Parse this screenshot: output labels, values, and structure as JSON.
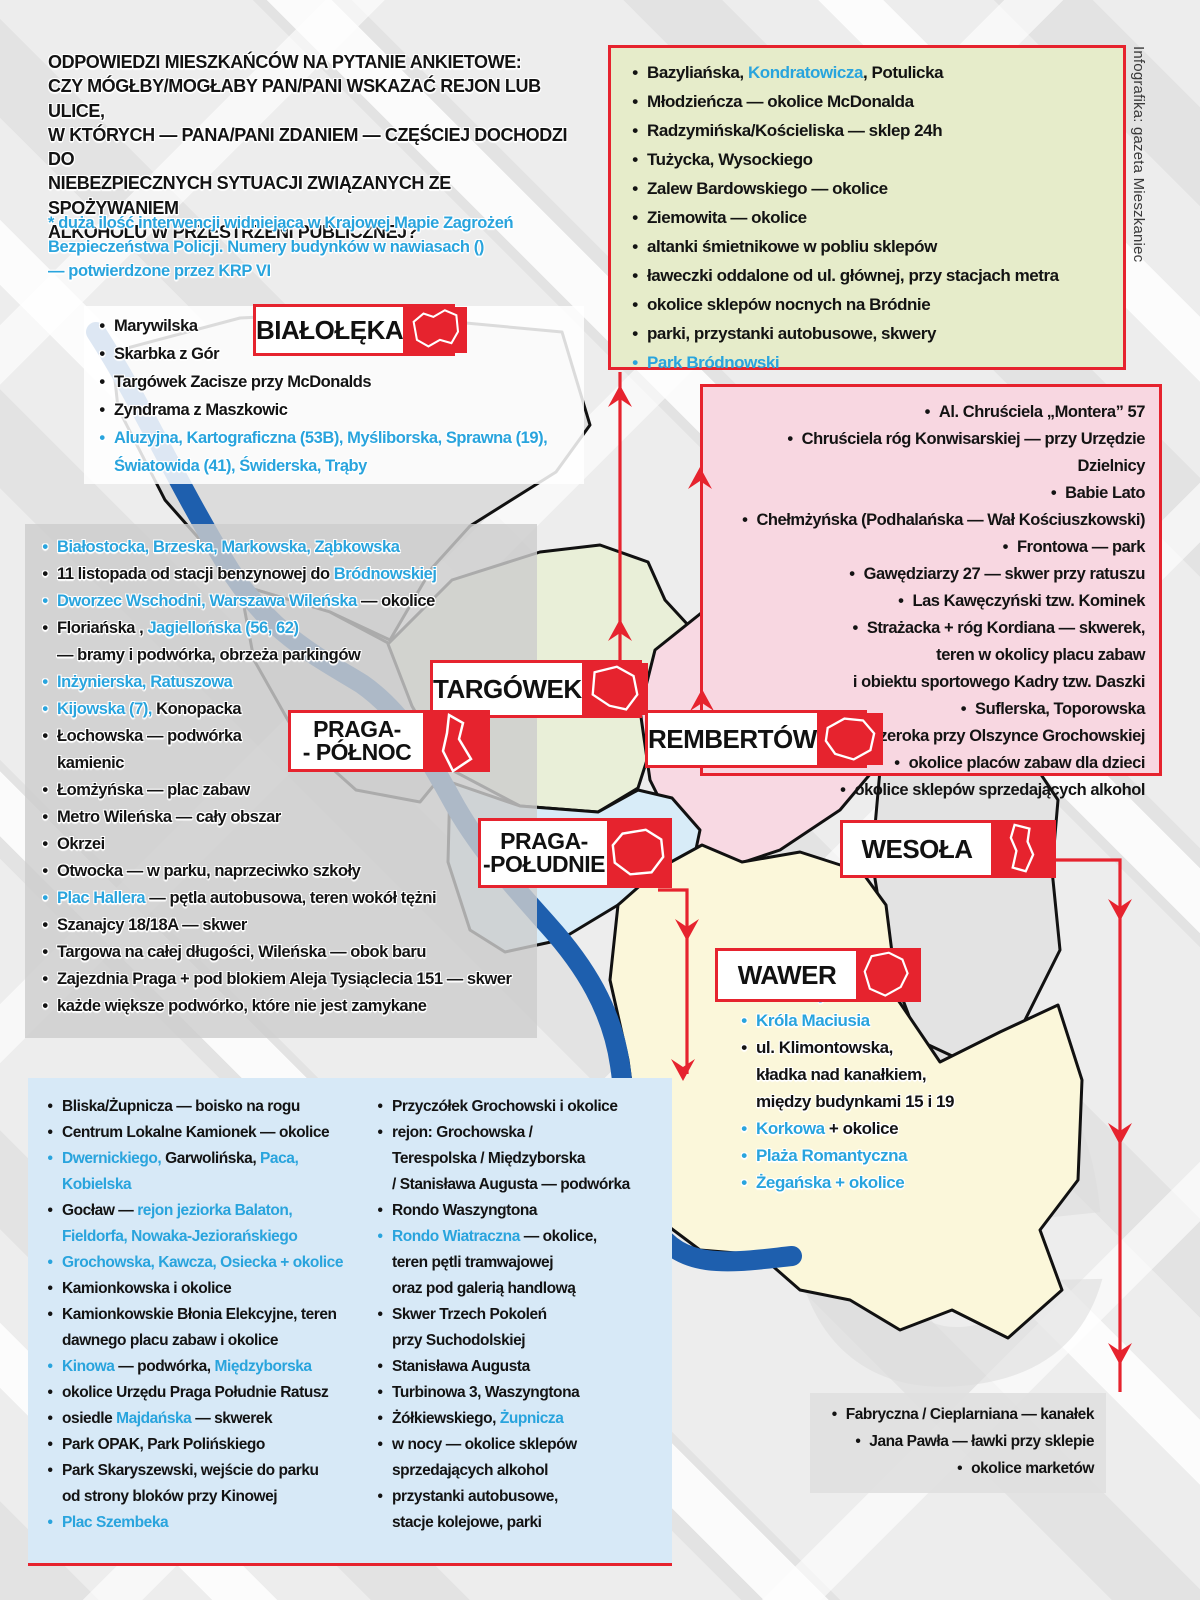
{
  "meta": {
    "credit": "Infografika: gazeta Mieszkaniec"
  },
  "colors": {
    "accent_red": "#e6232e",
    "link_blue": "#29a4dd",
    "river_blue": "#1e5fae",
    "green_box_bg": "#e6ecca",
    "pink_box_bg": "#f8d7e1",
    "blue_box_bg": "#d7e9f7",
    "gray_box_bg": "#cdcdcd",
    "wawer_yellow": "#fbf7d8",
    "district_gray": "#dcdcdc"
  },
  "header": {
    "title": "ODPOWIEDZI MIESZKAŃCÓW NA PYTANIE ANKIETOWE:\nCZY MÓGŁBY/MOGŁABY PAN/PANI WSKAZAĆ REJON LUB ULICE,\nW KTÓRYCH — PANA/PANI ZDANIEM — CZĘŚCIEJ DOCHODZI DO\nNIEBEZPIECZNYCH SYTUACJI ZWIĄZANYCH ZE SPOŻYWANIEM\nALKOHOLU W PRZESTRZENI PUBLICZNEJ?",
    "note": "* duża ilość interwencji widniejąca w Krajowej Mapie Zagrożeń\nBezpieczeństwa Policji. Numery budynków w nawiasach ()\n— potwierdzone przez KRP VI"
  },
  "districts": [
    {
      "id": "bialoleka",
      "label": "BIAŁOŁĘKA"
    },
    {
      "id": "targowek",
      "label": "TARGÓWEK"
    },
    {
      "id": "praga-polnoc",
      "label": "PRAGA-\n- PÓŁNOC"
    },
    {
      "id": "rembertow",
      "label": "REMBERTÓW"
    },
    {
      "id": "praga-poludnie",
      "label": "PRAGA-\n-POŁUDNIE"
    },
    {
      "id": "wesola",
      "label": "WESOŁA"
    },
    {
      "id": "wawer",
      "label": "WAWER"
    }
  ],
  "lists": {
    "bialoleka": {
      "items": [
        [
          {
            "t": "Marywilska",
            "c": "k"
          }
        ],
        [
          {
            "t": "Skarbka z Gór",
            "c": "k"
          }
        ],
        [
          {
            "t": "Targówek Zacisze przy McDonalds",
            "c": "k"
          }
        ],
        [
          {
            "t": "Zyndrama z Maszkowic",
            "c": "k"
          }
        ],
        [
          {
            "t": "Aluzyjna, Kartograficzna (53B), Myśliborska, Sprawna (19),\nŚwiatowida (41), Świderska, Trąby",
            "c": "b"
          }
        ]
      ]
    },
    "targowek": {
      "items": [
        [
          {
            "t": "Bazyliańska, ",
            "c": "k"
          },
          {
            "t": "Kondratowicza",
            "c": "b"
          },
          {
            "t": ", Potulicka",
            "c": "k"
          }
        ],
        [
          {
            "t": "Młodzieńcza — okolice McDonalda",
            "c": "k"
          }
        ],
        [
          {
            "t": "Radzymińska/Kościeliska — sklep 24h",
            "c": "k"
          }
        ],
        [
          {
            "t": "Tużycka, Wysockiego",
            "c": "k"
          }
        ],
        [
          {
            "t": "Zalew Bardowskiego — okolice",
            "c": "k"
          }
        ],
        [
          {
            "t": "Ziemowita — okolice",
            "c": "k"
          }
        ],
        [
          {
            "t": "altanki śmietnikowe w pobliu sklepów",
            "c": "k"
          }
        ],
        [
          {
            "t": "ławeczki oddalone od ul. głównej, przy stacjach metra",
            "c": "k"
          }
        ],
        [
          {
            "t": "okolice sklepów nocnych na Bródnie",
            "c": "k"
          }
        ],
        [
          {
            "t": "parki, przystanki autobusowe, skwery",
            "c": "k"
          }
        ],
        [
          {
            "t": "Park Bródnowski",
            "c": "b"
          }
        ]
      ]
    },
    "rembertow": {
      "items": [
        [
          {
            "t": "Al. Chruściela „Montera” 57",
            "c": "k"
          }
        ],
        [
          {
            "t": "Chruściela róg Konwisarskiej — przy Urzędzie Dzielnicy",
            "c": "k"
          }
        ],
        [
          {
            "t": "Babie Lato",
            "c": "k"
          }
        ],
        [
          {
            "t": "Chełmżyńska (Podhalańska — Wał Kościuszkowski)",
            "c": "k"
          }
        ],
        [
          {
            "t": "Frontowa — park",
            "c": "k"
          }
        ],
        [
          {
            "t": "Gawędziarzy 27 — skwer przy ratuszu",
            "c": "k"
          }
        ],
        [
          {
            "t": "Las Kawęczyński tzw. Kominek",
            "c": "k"
          }
        ],
        [
          {
            "t": "Strażacka + róg Kordiana — skwerek,\nteren w okolicy placu zabaw\ni obiektu sportowego Kadry tzw. Daszki",
            "c": "k"
          }
        ],
        [
          {
            "t": "Suflerska, Toporowska",
            "c": "k"
          }
        ],
        [
          {
            "t": "Szeroka przy Olszynce Grochowskiej",
            "c": "k"
          }
        ],
        [
          {
            "t": "okolice placów zabaw dla dzieci",
            "c": "k"
          }
        ],
        [
          {
            "t": "okolice sklepów sprzedających alkohol",
            "c": "k"
          }
        ]
      ]
    },
    "praga_polnoc": {
      "items": [
        [
          {
            "t": "Białostocka, Brzeska, Markowska, Ząbkowska",
            "c": "b"
          }
        ],
        [
          {
            "t": "11 listopada od stacji benzynowej do ",
            "c": "k"
          },
          {
            "t": "Bródnowskiej",
            "c": "b"
          }
        ],
        [
          {
            "t": "Dworzec Wschodni, Warszawa Wileńska",
            "c": "b"
          },
          {
            "t": " — okolice",
            "c": "k"
          }
        ],
        [
          {
            "t": "Floriańska , ",
            "c": "k"
          },
          {
            "t": "Jagiellońska (56, 62)",
            "c": "b"
          },
          {
            "t": "\n— bramy i podwórka, obrzeża parkingów",
            "c": "k"
          }
        ],
        [
          {
            "t": "Inżynierska, Ratuszowa",
            "c": "b"
          }
        ],
        [
          {
            "t": "Kijowska (7), ",
            "c": "b"
          },
          {
            "t": "Konopacka",
            "c": "k"
          }
        ],
        [
          {
            "t": "Łochowska — podwórka\nkamienic",
            "c": "k"
          }
        ],
        [
          {
            "t": "Łomżyńska — plac zabaw",
            "c": "k"
          }
        ],
        [
          {
            "t": "Metro Wileńska — cały obszar",
            "c": "k"
          }
        ],
        [
          {
            "t": "Okrzei",
            "c": "k"
          }
        ],
        [
          {
            "t": "Otwocka — w parku, naprzeciwko szkoły",
            "c": "k"
          }
        ],
        [
          {
            "t": "Plac Hallera",
            "c": "b"
          },
          {
            "t": " — pętla autobusowa, teren wokół tężni",
            "c": "k"
          }
        ],
        [
          {
            "t": "Szanajcy 18/18A — skwer",
            "c": "k"
          }
        ],
        [
          {
            "t": "Targowa na całej długości, Wileńska — obok baru",
            "c": "k"
          }
        ],
        [
          {
            "t": "Zajezdnia Praga + pod blokiem Aleja Tysiąclecia 151 — skwer",
            "c": "k"
          }
        ],
        [
          {
            "t": "każde większe podwórko, które nie jest zamykane",
            "c": "k"
          }
        ]
      ]
    },
    "praga_poludnie_col1": {
      "items": [
        [
          {
            "t": "Bliska/Żupnicza — boisko na rogu",
            "c": "k"
          }
        ],
        [
          {
            "t": "Centrum Lokalne Kamionek — okolice",
            "c": "k"
          }
        ],
        [
          {
            "t": "Dwernickiego, ",
            "c": "b"
          },
          {
            "t": "Garwolińska, ",
            "c": "k"
          },
          {
            "t": "Paca,\nKobielska",
            "c": "b"
          }
        ],
        [
          {
            "t": "Gocław — ",
            "c": "k"
          },
          {
            "t": "rejon jeziorka Balaton,\nFieldorfa, Nowaka-Jeziorańskiego",
            "c": "b"
          }
        ],
        [
          {
            "t": "Grochowska, Kawcza, Osiecka + okolice",
            "c": "b"
          }
        ],
        [
          {
            "t": "Kamionkowska i okolice",
            "c": "k"
          }
        ],
        [
          {
            "t": "Kamionkowskie Błonia Elekcyjne, teren\ndawnego placu zabaw i okolice",
            "c": "k"
          }
        ],
        [
          {
            "t": "Kinowa",
            "c": "b"
          },
          {
            "t": " — podwórka, ",
            "c": "k"
          },
          {
            "t": "Międzyborska",
            "c": "b"
          }
        ],
        [
          {
            "t": "okolice Urzędu Praga Południe Ratusz",
            "c": "k"
          }
        ],
        [
          {
            "t": "osiedle ",
            "c": "k"
          },
          {
            "t": "Majdańska",
            "c": "b"
          },
          {
            "t": " — skwerek",
            "c": "k"
          }
        ],
        [
          {
            "t": "Park OPAK, Park Polińskiego",
            "c": "k"
          }
        ],
        [
          {
            "t": "Park Skaryszewski, wejście do parku\nod strony bloków przy Kinowej",
            "c": "k"
          }
        ],
        [
          {
            "t": "Plac Szembeka",
            "c": "b"
          }
        ]
      ]
    },
    "praga_poludnie_col2": {
      "items": [
        [
          {
            "t": "Przyczółek Grochowski i okolice",
            "c": "k"
          }
        ],
        [
          {
            "t": "rejon: Grochowska /\nTerespolska / Międzyborska\n/ Stanisława Augusta — podwórka",
            "c": "k"
          }
        ],
        [
          {
            "t": "Rondo Waszyngtona",
            "c": "k"
          }
        ],
        [
          {
            "t": "Rondo Wiatraczna",
            "c": "b"
          },
          {
            "t": " — okolice,\nteren pętli tramwajowej\noraz pod galerią handlową",
            "c": "k"
          }
        ],
        [
          {
            "t": "Skwer Trzech Pokoleń\nprzy Suchodolskiej",
            "c": "k"
          }
        ],
        [
          {
            "t": "Stanisława Augusta",
            "c": "k"
          }
        ],
        [
          {
            "t": "Turbinowa 3, Waszyngtona",
            "c": "k"
          }
        ],
        [
          {
            "t": "Żółkiewskiego, ",
            "c": "k"
          },
          {
            "t": "Żupnicza",
            "c": "b"
          }
        ],
        [
          {
            "t": "w nocy — okolice sklepów\nsprzedających alkohol",
            "c": "k"
          }
        ],
        [
          {
            "t": "przystanki autobusowe,\nstacje kolejowe, parki",
            "c": "k"
          }
        ]
      ]
    },
    "wawer": {
      "items": [
        [
          {
            "t": "Derkaczy + okolice",
            "c": "b"
          }
        ],
        [
          {
            "t": "Króla Maciusia",
            "c": "b"
          }
        ],
        [
          {
            "t": "ul. Klimontowska,\nkładka nad kanałkiem,\nmiędzy budynkami 15 i 19",
            "c": "k"
          }
        ],
        [
          {
            "t": "Korkowa",
            "c": "b"
          },
          {
            "t": " + okolice",
            "c": "k"
          }
        ],
        [
          {
            "t": "Plaża Romantyczna",
            "c": "b"
          }
        ],
        [
          {
            "t": "Żegańska + okolice",
            "c": "b"
          }
        ]
      ]
    },
    "wesola": {
      "items": [
        [
          {
            "t": "Fabryczna / Cieplarniana — kanałek",
            "c": "k"
          }
        ],
        [
          {
            "t": "Jana Pawła — ławki przy sklepie",
            "c": "k"
          }
        ],
        [
          {
            "t": "okolice marketów",
            "c": "k"
          }
        ]
      ]
    }
  }
}
